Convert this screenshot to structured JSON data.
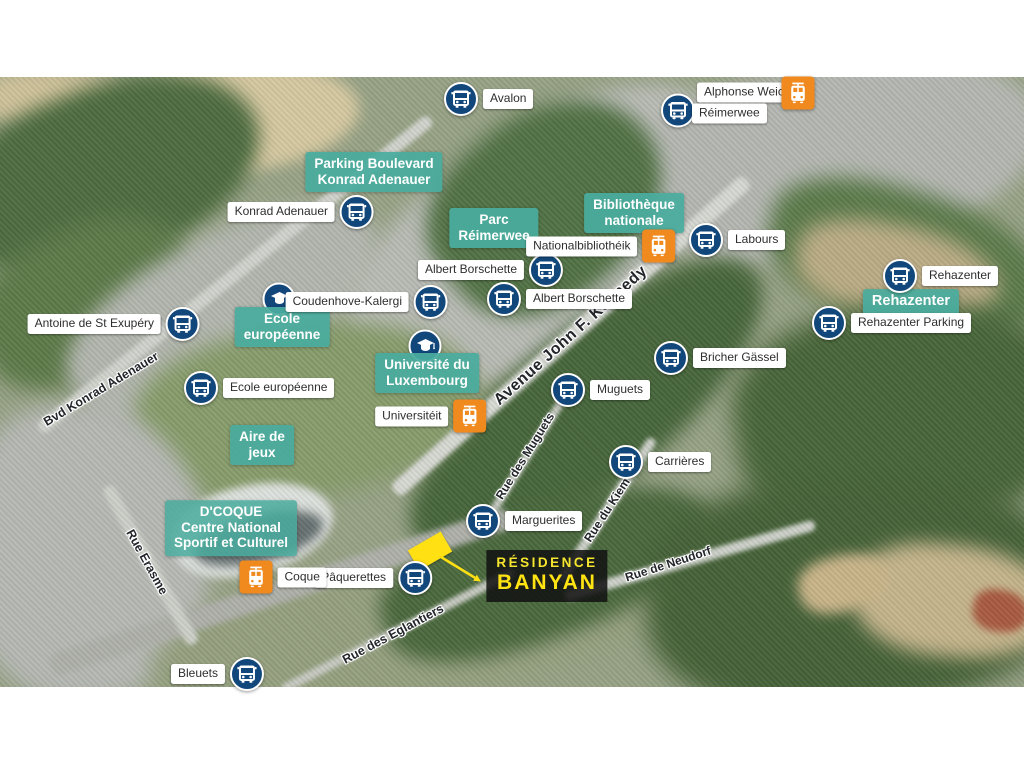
{
  "map": {
    "title_plot": {
      "line1": "RÉSIDENCE",
      "line2": "BANYAN"
    },
    "colors": {
      "bus_icon_bg": "#12477C",
      "tram_icon_bg": "#F18A1E",
      "poi_label_bg": "#49AC9E",
      "stop_label_text": "#2E2E2E",
      "street_text": "#22262A",
      "residence_bg": "#121212",
      "residence_yellow": "#FFE312",
      "parcel_yellow": "#FFE013"
    },
    "icons": {
      "bus": "bus-icon",
      "tram": "tram-icon",
      "school": "graduation-cap-icon"
    },
    "stops": [
      {
        "name": "Avalon"
      },
      {
        "name": "Alphonse Weicker",
        "name2": "Réimerwee"
      },
      {
        "name": "Konrad Adenauer"
      },
      {
        "name": "Labours"
      },
      {
        "name": "Albert Borschette"
      },
      {
        "name": "Albert Borschette"
      },
      {
        "name": "Rehazenter"
      },
      {
        "name": "Rehazenter Parking"
      },
      {
        "name": "Antoine de St Exupéry"
      },
      {
        "name": "Coudenhove-Kalergi"
      },
      {
        "name": "Ecole européenne"
      },
      {
        "name": "Muguets"
      },
      {
        "name": "Bricher Gässel"
      },
      {
        "name": "Carrières"
      },
      {
        "name": "Marguerites"
      },
      {
        "name": "Pâquerettes"
      },
      {
        "name": "Bleuets"
      }
    ],
    "trams": [
      {
        "label": ""
      },
      {
        "label": "Nationalbibliothéik"
      },
      {
        "label": "Universitéit"
      },
      {
        "label": "Coque"
      }
    ],
    "pois": [
      {
        "lines": [
          "Parking Boulevard",
          "Konrad Adenauer"
        ]
      },
      {
        "lines": [
          "Parc",
          "Réimerwee"
        ]
      },
      {
        "lines": [
          "Bibliothèque",
          "nationale"
        ]
      },
      {
        "lines": [
          "Ecole",
          "européenne"
        ]
      },
      {
        "lines": [
          "Université du",
          "Luxembourg"
        ]
      },
      {
        "lines": [
          "Aire de",
          "jeux"
        ]
      },
      {
        "lines": [
          "Rehazenter"
        ]
      },
      {
        "lines": [
          "D'COQUE",
          "Centre National",
          "Sportif et Culturel"
        ]
      }
    ],
    "streets": [
      {
        "name": "Bvd Konrad Adenauer"
      },
      {
        "name": "Avenue John F. Kennedy"
      },
      {
        "name": "Rue Erasme"
      },
      {
        "name": "Rue des Muguets"
      },
      {
        "name": "Rue du Kiem"
      },
      {
        "name": "Rue de Neudorf"
      },
      {
        "name": "Rue des Eglantiers"
      }
    ]
  }
}
